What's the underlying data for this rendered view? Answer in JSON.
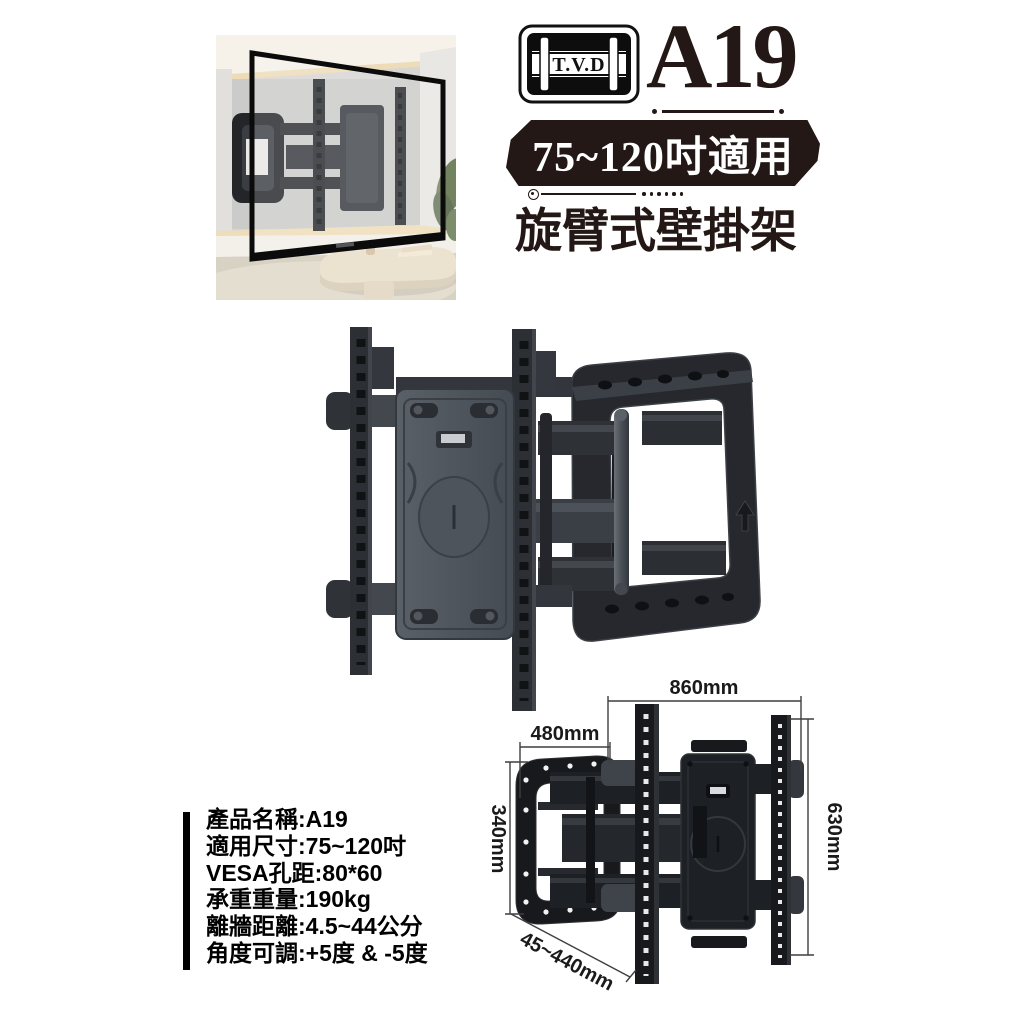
{
  "header": {
    "brand": "T.V.D",
    "model": "A19",
    "size_badge": "75~120吋適用",
    "product_type": "旋臂式壁掛架"
  },
  "specs": {
    "lines": [
      "產品名稱:A19",
      "適用尺寸:75~120吋",
      "VESA孔距:80*60",
      "承重重量:190kg",
      "離牆距離:4.5~44公分",
      "角度可調:+5度 & -5度"
    ]
  },
  "dimensions": {
    "total_width": "860mm",
    "wall_plate_width": "480mm",
    "wall_plate_height": "340mm",
    "bracket_height": "630mm",
    "wall_distance": "45~440mm"
  },
  "colors": {
    "ink": "#231815",
    "badge_background": "#231815",
    "badge_text": "#ffffff",
    "metal_dark": "#26282d",
    "metal_mid": "#3a3e44",
    "metal_light": "#565c64"
  },
  "icons": {
    "brand_logo": "tv-bracket-logo"
  }
}
